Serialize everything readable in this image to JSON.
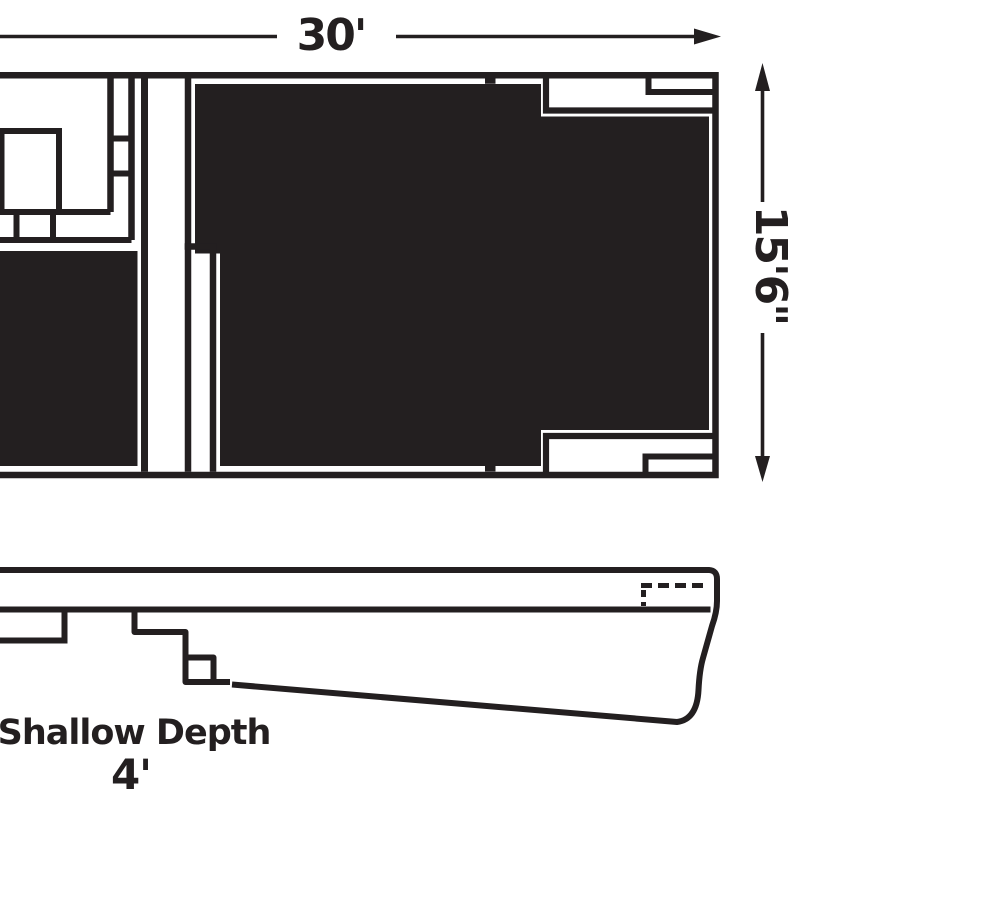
{
  "diagram": {
    "type": "swimming-pool-spec-drawing",
    "views": {
      "plan": "pool-top-view",
      "profile": "pool-depth-side-view"
    },
    "labels": {
      "length": "30'",
      "width": "15'6\"",
      "depth_title": "Shallow Depth",
      "depth_value": "4'"
    },
    "icons": {
      "length_arrow": "arrow-right",
      "width_arrow_top": "arrow-up",
      "width_arrow_bottom": "arrow-down"
    },
    "colors": {
      "ink": "#231f20",
      "background": "#ffffff",
      "water_fill": "#231f20"
    }
  }
}
